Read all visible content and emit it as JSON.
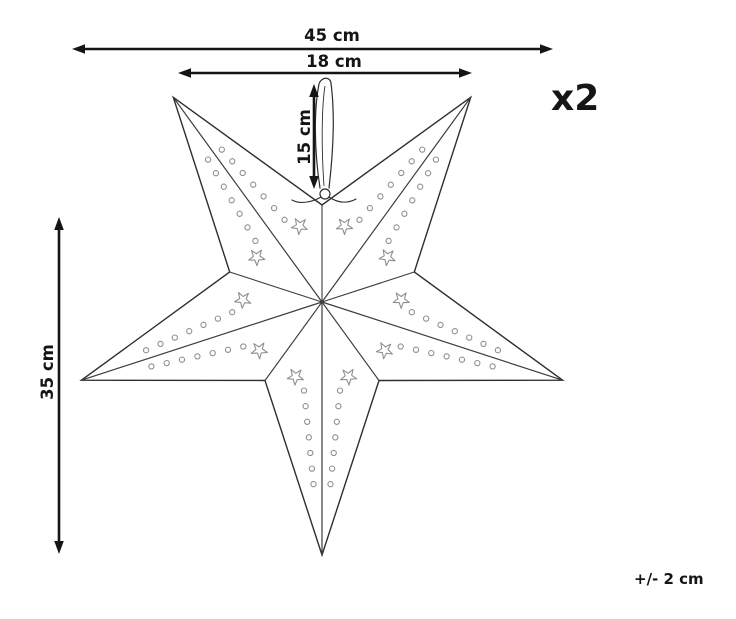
{
  "page": {
    "width": 736,
    "height": 619,
    "background": "#ffffff"
  },
  "colors": {
    "outline": "#2e2e2e",
    "fold_line": "#3c3c3c",
    "perforation": "#8f8f8f",
    "annotation": "#151515",
    "paper_fill": "#ffffff"
  },
  "annotations": {
    "quantity": "x2",
    "tolerance": "+/- 2 cm"
  },
  "dimensions": [
    {
      "id": "overall-width",
      "label": "45 cm",
      "orientation": "horizontal",
      "from": 72,
      "to": 553,
      "at": 49,
      "label_x": 332,
      "label_y": 41,
      "rotated": false
    },
    {
      "id": "top-points-width",
      "label": "18 cm",
      "orientation": "horizontal",
      "from": 178,
      "to": 472,
      "at": 73,
      "label_x": 334,
      "label_y": 67,
      "rotated": false
    },
    {
      "id": "loop-length",
      "label": "15 cm",
      "orientation": "vertical",
      "from": 84,
      "to": 189,
      "at": 314,
      "label_x": 310,
      "label_y": 137,
      "rotated": true
    },
    {
      "id": "star-height",
      "label": "35 cm",
      "orientation": "vertical",
      "from": 217,
      "to": 554,
      "at": 59,
      "label_x": 53,
      "label_y": 372,
      "rotated": true
    }
  ],
  "star": {
    "center_x": 322,
    "center_y": 302,
    "outer_radius": 253,
    "inner_radius": 97,
    "point_count": 5,
    "bottom_tip_angle_deg": 90,
    "decoration": {
      "circles_per_row": 7,
      "circle_radius": 2.6,
      "row_t_start": 0.35,
      "row_t_end": 0.72,
      "row_offset_start": 18,
      "row_offset_end": 8.5,
      "mini_star_t": 0.295,
      "mini_star_offset": 26.5,
      "mini_star_outer_r": 8.5,
      "mini_star_inner_r": 3.4
    }
  },
  "ribbon": {
    "knot_x": 325,
    "knot_y": 194,
    "knot_radius": 5,
    "loop_height": 118
  }
}
